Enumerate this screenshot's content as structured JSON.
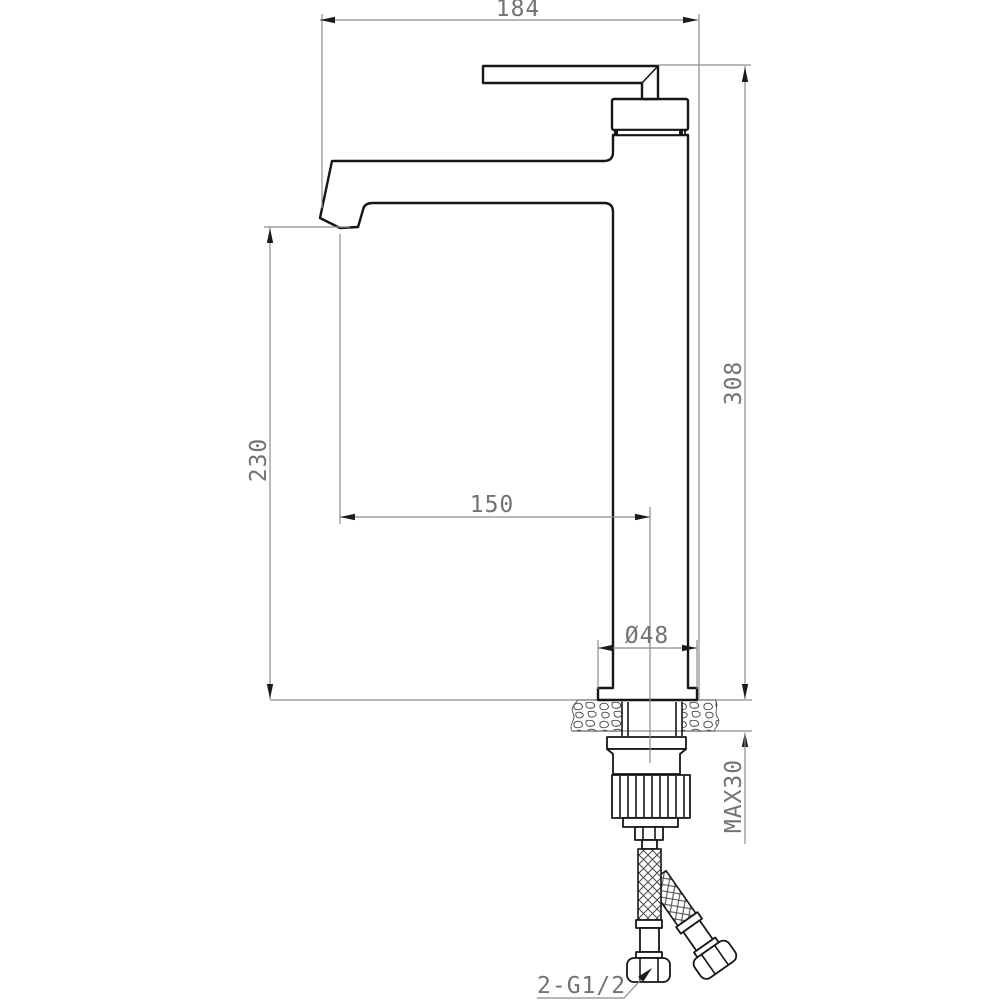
{
  "drawing": {
    "type": "faucet installation technical drawing",
    "colors": {
      "background": "#ffffff",
      "outline": "#161616",
      "dimension_lines": "#8c8c8c",
      "dimension_text": "#737373"
    },
    "dimensions": {
      "overall_projection": {
        "label": "184"
      },
      "overall_height": {
        "label": "308"
      },
      "spout_outlet_height": {
        "label": "230"
      },
      "spout_reach": {
        "label": "150"
      },
      "base_diameter": {
        "label": "Ø48"
      },
      "max_deck_thickness": {
        "label": "MAX30"
      },
      "inlet_thread": {
        "label": "2-G1/2"
      }
    }
  }
}
